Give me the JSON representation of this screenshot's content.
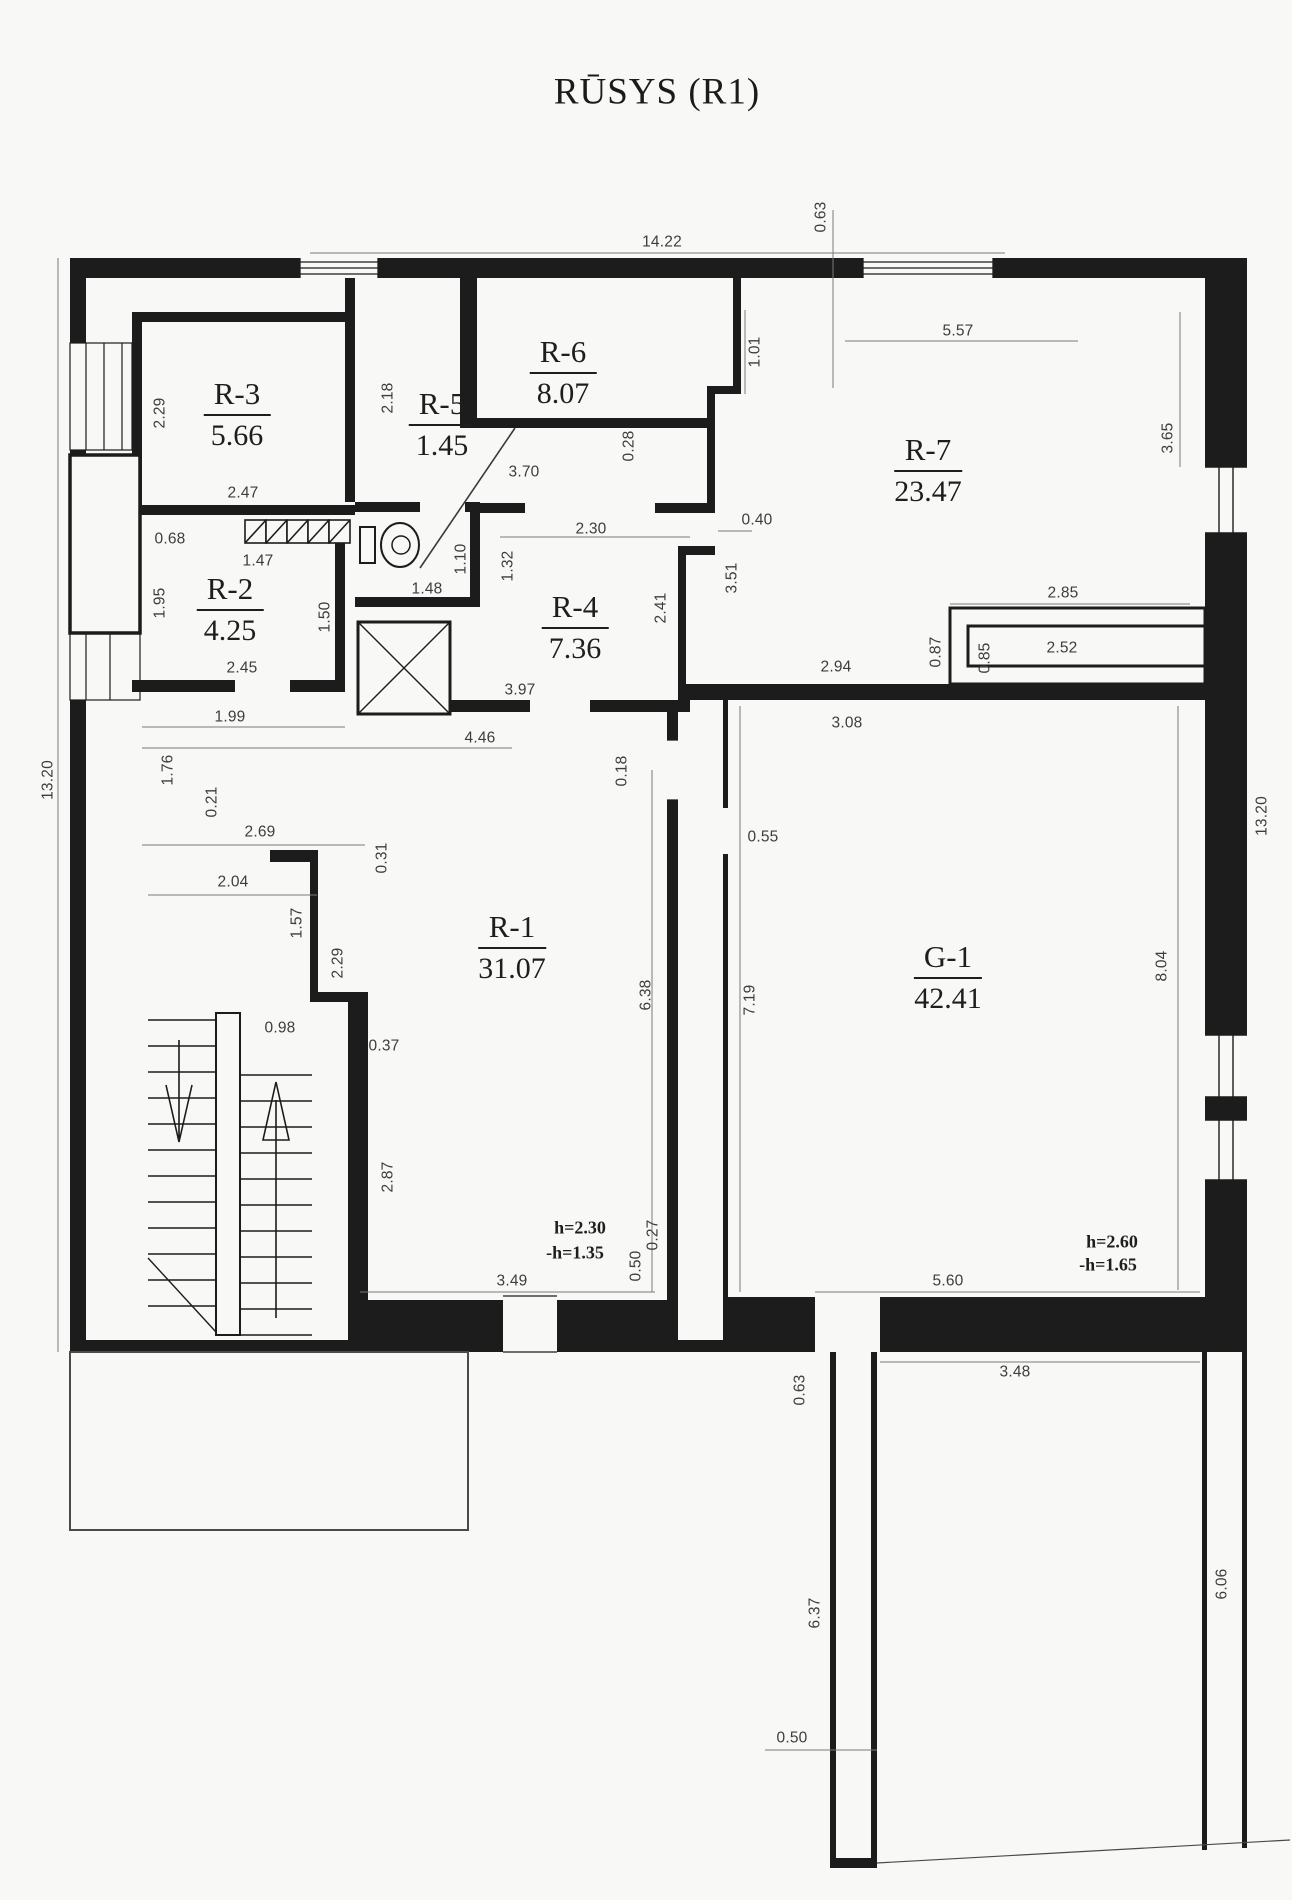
{
  "title": "RŪSYS (R1)",
  "rooms": [
    {
      "id": "R-3",
      "area": "5.66"
    },
    {
      "id": "R-5",
      "area": "1.45"
    },
    {
      "id": "R-6",
      "area": "8.07"
    },
    {
      "id": "R-7",
      "area": "23.47"
    },
    {
      "id": "R-2",
      "area": "4.25"
    },
    {
      "id": "R-4",
      "area": "7.36"
    },
    {
      "id": "R-1",
      "area": "31.07"
    },
    {
      "id": "G-1",
      "area": "42.41"
    }
  ],
  "height_notes": [
    {
      "text": "h=2.30"
    },
    {
      "text": "-h=1.35"
    },
    {
      "text": "h=2.60"
    },
    {
      "text": "-h=1.65"
    }
  ],
  "dims": [
    {
      "text": "14.22"
    },
    {
      "text": "0.63"
    },
    {
      "text": "5.57"
    },
    {
      "text": "1.01"
    },
    {
      "text": "3.65"
    },
    {
      "text": "2.29"
    },
    {
      "text": "2.47"
    },
    {
      "text": "2.18"
    },
    {
      "text": "3.70"
    },
    {
      "text": "0.28"
    },
    {
      "text": "0.68"
    },
    {
      "text": "1.47"
    },
    {
      "text": "1.95"
    },
    {
      "text": "1.50"
    },
    {
      "text": "1.48"
    },
    {
      "text": "1.10"
    },
    {
      "text": "1.32"
    },
    {
      "text": "2.30"
    },
    {
      "text": "0.40"
    },
    {
      "text": "3.51"
    },
    {
      "text": "2.41"
    },
    {
      "text": "2.94"
    },
    {
      "text": "0.87"
    },
    {
      "text": "2.85"
    },
    {
      "text": "0.85"
    },
    {
      "text": "2.52"
    },
    {
      "text": "3.08"
    },
    {
      "text": "2.45"
    },
    {
      "text": "1.99"
    },
    {
      "text": "4.46"
    },
    {
      "text": "0.18"
    },
    {
      "text": "0.55"
    },
    {
      "text": "1.76"
    },
    {
      "text": "0.21"
    },
    {
      "text": "2.69"
    },
    {
      "text": "0.31"
    },
    {
      "text": "2.04"
    },
    {
      "text": "1.57"
    },
    {
      "text": "2.29"
    },
    {
      "text": "0.98"
    },
    {
      "text": "0.37"
    },
    {
      "text": "2.87"
    },
    {
      "text": "6.38"
    },
    {
      "text": "7.19"
    },
    {
      "text": "8.04"
    },
    {
      "text": "13.20"
    },
    {
      "text": "13.20"
    },
    {
      "text": "3.49"
    },
    {
      "text": "0.27"
    },
    {
      "text": "0.50"
    },
    {
      "text": "5.60"
    },
    {
      "text": "3.48"
    },
    {
      "text": "0.63"
    },
    {
      "text": "6.37"
    },
    {
      "text": "0.50"
    },
    {
      "text": "6.06"
    },
    {
      "text": "3.97"
    }
  ],
  "colors": {
    "wall": "#1c1c1c",
    "paper": "#f8f8f6",
    "dim_text": "#3d3d3d"
  }
}
